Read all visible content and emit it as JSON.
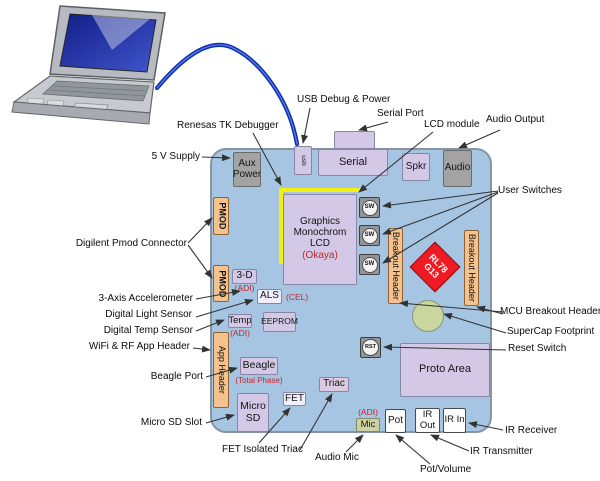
{
  "title": "RL78 demo board connection diagram",
  "colors": {
    "board_fill": "#a6c5e2",
    "module_purple": "#d3c9e7",
    "header_orange": "#f3c28e",
    "connector_gray": "#a3a3a3",
    "mcu_red": "#ee1b24",
    "supercap_olive": "#cbd69e",
    "mic_olive": "#ced2a2",
    "cable_blue": "#0b2fb0",
    "annotation_red": "#c1272d",
    "lcd_outline_yellow": "#f4f10c"
  },
  "board": {
    "mcu": {
      "line1": "RL78",
      "line2": "G13"
    }
  },
  "components": {
    "aux_power": "Aux Power",
    "usb": "usb",
    "serial": "Serial",
    "spkr": "Spkr",
    "audio": "Audio",
    "pmod": "PMOD",
    "lcd": "Graphics Monochrom LCD",
    "sw": "SW",
    "breakout_header": "Breakout Header",
    "accel_3d": "3-D",
    "als": "ALS",
    "temp": "Temp",
    "eeprom": "EEPROM",
    "app_header": "App Header",
    "beagle": "Beagle",
    "micro_sd": "Micro SD",
    "fet": "FET",
    "triac": "Triac",
    "mic": "Mic",
    "pot": "Pot",
    "ir_out": "IR Out",
    "ir_in": "IR In",
    "proto_area": "Proto Area",
    "rst": "RST"
  },
  "annotations": {
    "okaya": "(Okaya)",
    "adi": "(ADI)",
    "cel": "(CEL)",
    "total_phase": "(Total Phase)"
  },
  "callouts": {
    "usb_debug_power": "USB Debug & Power",
    "serial_port": "Serial Port",
    "lcd_module": "LCD module",
    "audio_output": "Audio Output",
    "renesas_tk": "Renesas TK Debugger",
    "supply_5v": "5 V Supply",
    "user_switches": "User Switches",
    "digilent_pmod": "Digilent Pmod Connector",
    "accelerometer": "3-Axis Accelerometer",
    "light_sensor": "Digital Light Sensor",
    "temp_sensor": "Digital Temp Sensor",
    "wifi_rf": "WiFi & RF App Header",
    "beagle_port": "Beagle Port",
    "micro_sd_slot": "Micro SD Slot",
    "fet_triac": "FET Isolated Triac",
    "audio_mic": "Audio Mic",
    "pot_volume": "Pot/Volume",
    "ir_transmitter": "IR Transmitter",
    "ir_receiver": "IR Receiver",
    "reset_switch": "Reset Switch",
    "supercap": "SuperCap Footprint",
    "mcu_breakout": "MCU Breakout Headers"
  }
}
